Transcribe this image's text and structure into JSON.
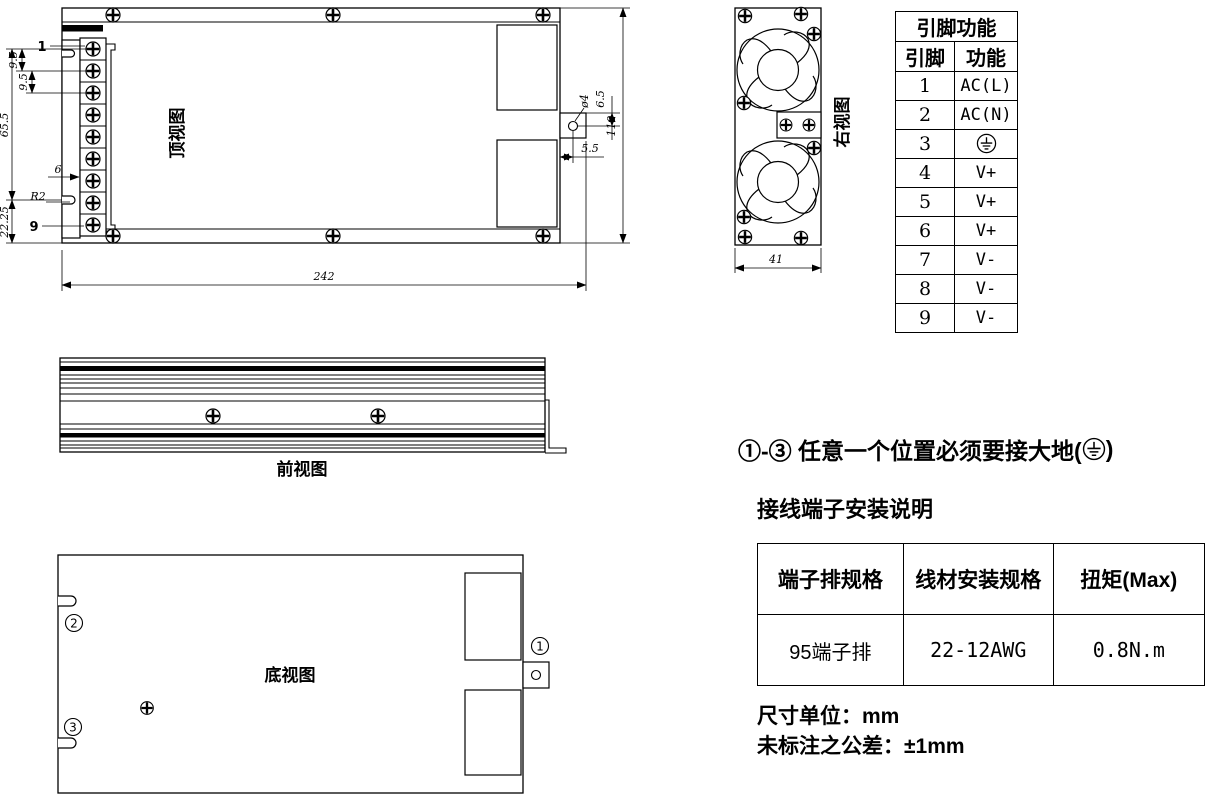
{
  "drawing": {
    "views": {
      "top": {
        "label": "顶视图",
        "pin_first": "1",
        "pin_last": "9",
        "dims": {
          "pitch_a": "9.5",
          "pitch_b": "9.5",
          "terminal_height": "65.5",
          "flange_width": "6",
          "corner_radius": "R2",
          "bottom_offset": "22.25",
          "length": "242",
          "hole_dia": "ø4",
          "hole_top_offset": "6.5",
          "hole_side_offset": "5.5",
          "width": "110"
        }
      },
      "front": {
        "label": "前视图"
      },
      "bottom": {
        "label": "底视图",
        "marker_1": "1",
        "marker_2": "2",
        "marker_3": "3"
      },
      "right": {
        "label": "右视图",
        "dims": {
          "width": "41"
        }
      }
    },
    "pin_table": {
      "title": "引脚功能",
      "col_pin": "引脚",
      "col_func": "功能",
      "rows": [
        {
          "pin": "1",
          "func": "AC(L)"
        },
        {
          "pin": "2",
          "func": "AC(N)"
        },
        {
          "pin": "3",
          "func_icon": "earth-ground"
        },
        {
          "pin": "4",
          "func": "V+"
        },
        {
          "pin": "5",
          "func": "V+"
        },
        {
          "pin": "6",
          "func": "V+"
        },
        {
          "pin": "7",
          "func": "V-"
        },
        {
          "pin": "8",
          "func": "V-"
        },
        {
          "pin": "9",
          "func": "V-"
        }
      ]
    },
    "ground_note": {
      "prefix": "①-③ 任意一个位置必须要接大地(",
      "suffix": ")"
    },
    "terminal_section": {
      "heading": "接线端子安装说明",
      "table": {
        "headers": [
          "端子排规格",
          "线材安装规格",
          "扭矩(Max)"
        ],
        "row": [
          "95端子排",
          "22-12AWG",
          "0.8N.m"
        ]
      }
    },
    "footnotes": {
      "units": "尺寸单位：mm",
      "tolerance": "未标注之公差：±1mm"
    }
  }
}
